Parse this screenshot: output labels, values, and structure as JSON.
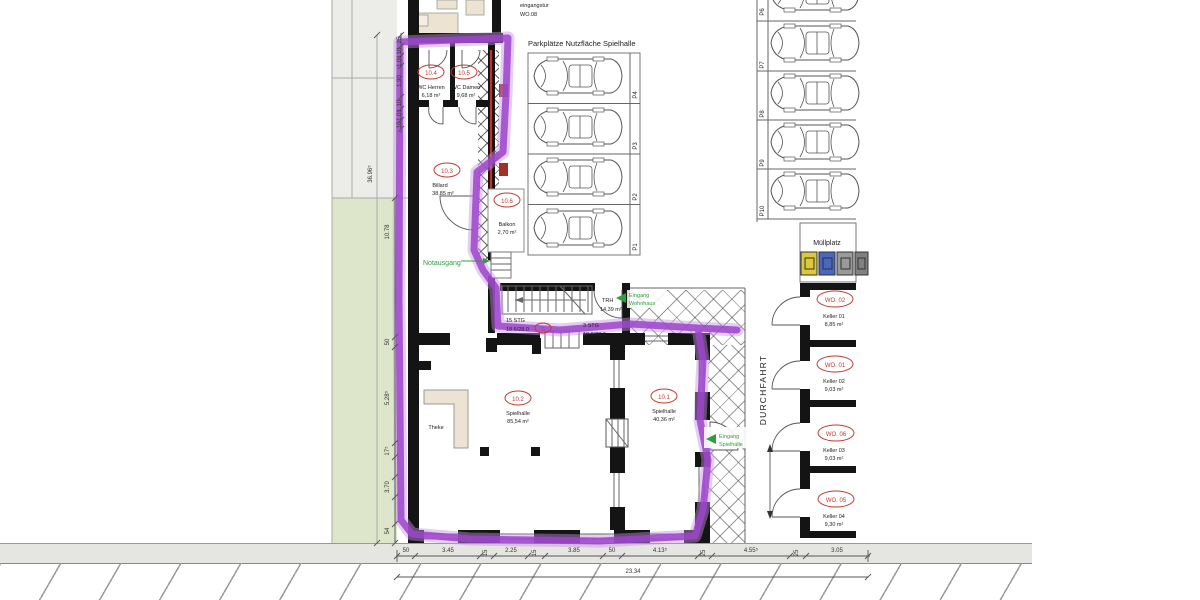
{
  "site": {
    "upper_unit_label": "eingangstur",
    "upper_unit_id": "WO.08"
  },
  "parking_main": {
    "title": "Parkplätze Nutzfläche Spielhalle",
    "stalls": [
      "P4",
      "P3",
      "P2",
      "P1"
    ]
  },
  "parking_right": {
    "stalls": [
      "P6",
      "P7",
      "P8",
      "P9",
      "P10"
    ]
  },
  "rooms": [
    {
      "id": "10.4",
      "name": "WC Herren",
      "area": "6,18 m²"
    },
    {
      "id": "10.5",
      "name": "WC Damen",
      "area": "9,68 m²"
    },
    {
      "id": "10.3",
      "name": "Billard",
      "area": "38,85 m²"
    },
    {
      "id": "10.6",
      "name": "Balkon",
      "area": "2,70 m²"
    },
    {
      "id": "10.2",
      "name": "Spielhalle",
      "area": "85,54 m²"
    },
    {
      "id": "10.1",
      "name": "Spielhalle",
      "area": "40,36 m²"
    }
  ],
  "furniture": {
    "counter": "Theke"
  },
  "stairwell": {
    "label": "TRH",
    "area": "14,39 m²",
    "stairs_main": "15 STG",
    "stairs_main_dim": "18.6/28.0",
    "stairs_small": "3 STG",
    "stairs_small_dim": "18.6/28.0",
    "badge": "G"
  },
  "entrances": {
    "emergency_exit": "Notausgang",
    "house_line1": "Eingang",
    "house_line2": "Wohnhaus",
    "hall_line1": "Eingang",
    "hall_line2": "Spielhalle"
  },
  "waste": {
    "label": "Müllplatz"
  },
  "driveway": {
    "label": "DURCHFAHRT"
  },
  "cellar": [
    {
      "unit": "WO. 02",
      "room": "Keller 01",
      "area": "8,85 m²"
    },
    {
      "unit": "WO. 01",
      "room": "Keller 02",
      "area": "9,03 m²"
    },
    {
      "unit": "WO. 06",
      "room": "Keller 03",
      "area": "9,03 m²"
    },
    {
      "unit": "WO. 05",
      "room": "Keller 04",
      "area": "9,30 m²"
    }
  ],
  "dimensions": {
    "left_top": [
      "25",
      "10",
      "1.01",
      "1.90",
      "10",
      "1.01",
      "10"
    ],
    "left_side": [
      "36.96⁵",
      "10.78",
      "50",
      "5.28⁵",
      "17⁵",
      "3.70",
      "54"
    ],
    "bottom": [
      "50",
      "3.45",
      "15",
      "2.25",
      "15",
      "3.85",
      "50",
      "4.13⁵",
      "25",
      "4.55⁵",
      "25",
      "3.05"
    ],
    "bottom_total": "23.34"
  },
  "colors": {
    "highlight_purple": "#9d44cc",
    "accent_red": "#c03a30",
    "accent_green": "#2f9e3f",
    "bin_yellow": "#ddc83a",
    "bin_blue": "#4a66c0",
    "bin_gray": "#9a9a9a",
    "lawn_green": "#dde6ca"
  }
}
